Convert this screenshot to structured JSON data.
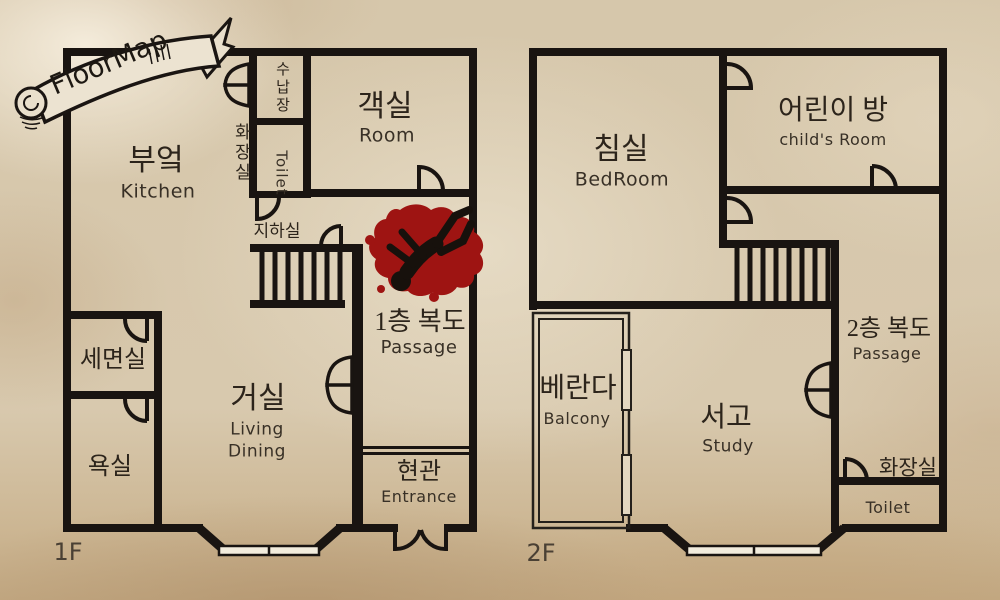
{
  "banner": {
    "title": "FloorMap"
  },
  "colors": {
    "wall": "#191411",
    "blood": "#9e1412",
    "paper": "#d8c9af",
    "window": "#f2ecdd",
    "ink": "#2c241b"
  },
  "floor1": {
    "label": "1F",
    "kitchen_ko": "부엌",
    "kitchen_en": "Kitchen",
    "closet_ko": "수납장",
    "toilet_ko": "화장실",
    "toilet_en": "Toilet",
    "guest_ko": "객실",
    "guest_en": "Room",
    "basement_ko": "지하실",
    "passage_ko": "1층 복도",
    "passage_en": "Passage",
    "washroom_ko": "세면실",
    "bath_ko": "욕실",
    "living_ko": "거실",
    "living_en_line1": "Living",
    "living_en_line2": "Dining",
    "entrance_ko": "현관",
    "entrance_en": "Entrance"
  },
  "floor2": {
    "label": "2F",
    "bedroom_ko": "침실",
    "bedroom_en": "BedRoom",
    "child_ko": "어린이 방",
    "child_en": "child's Room",
    "balcony_ko": "베란다",
    "balcony_en": "Balcony",
    "study_ko": "서고",
    "study_en": "Study",
    "passage_ko": "2층 복도",
    "passage_en": "Passage",
    "toilet_ko": "화장실",
    "toilet_en": "Toilet"
  }
}
